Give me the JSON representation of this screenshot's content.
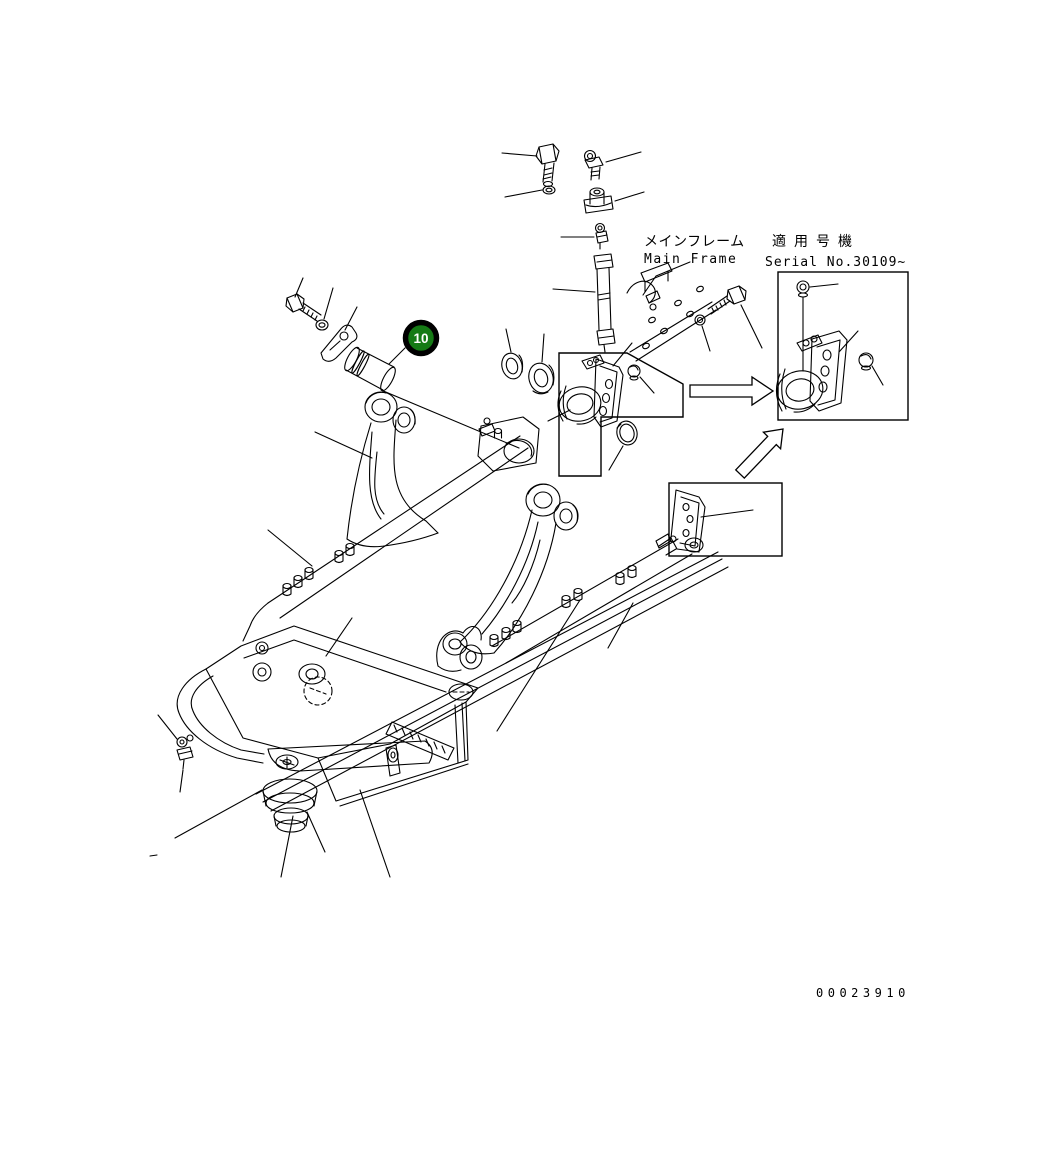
{
  "page": {
    "background": "#ffffff",
    "line_color": "#000000"
  },
  "labels": {
    "main_frame": {
      "jp": "メインフレーム",
      "en": "Main Frame"
    },
    "applicable_serial": {
      "jp": "適用号機",
      "en": "Serial No.30109~"
    }
  },
  "callout": {
    "number": "10",
    "fill": "#157a15",
    "ring_color": "#000000",
    "text_color": "#ffffff"
  },
  "drawing_number": "00023910"
}
